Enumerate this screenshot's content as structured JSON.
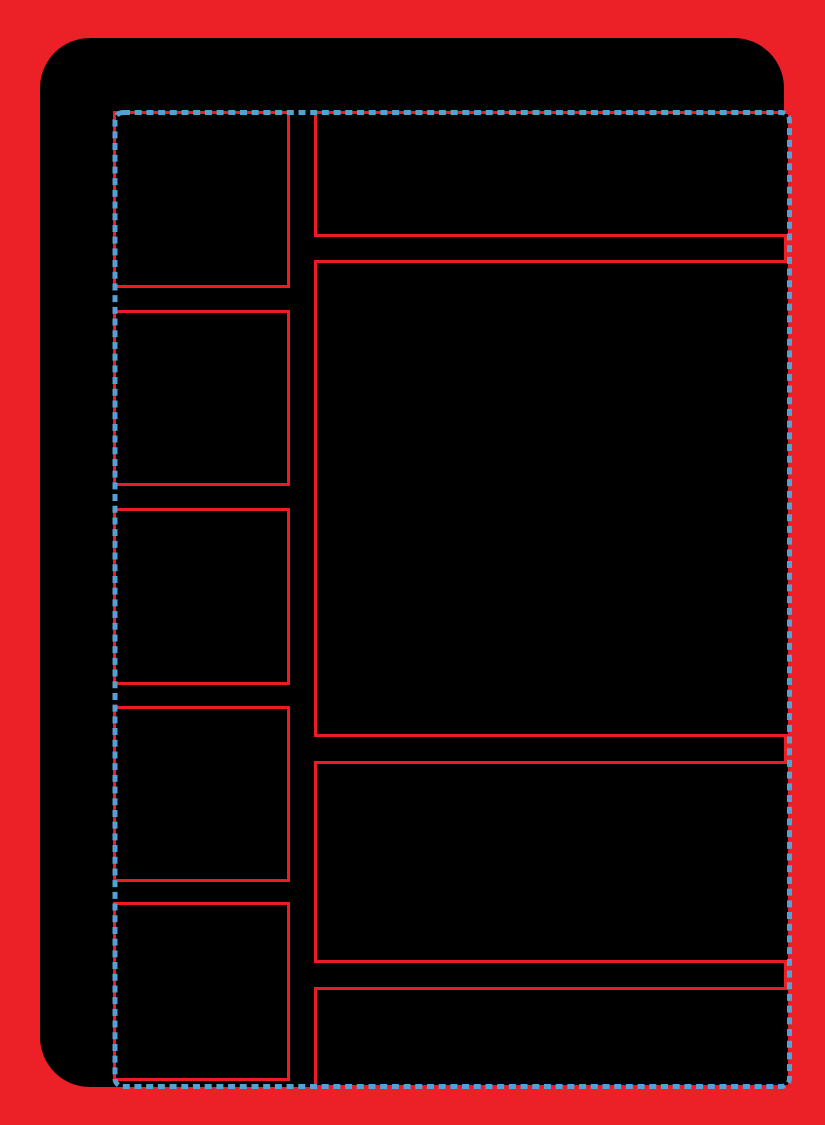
{
  "template": {
    "type": "blank-card-layout-template",
    "text_content": "none"
  },
  "colors": {
    "page_background": "#EC2127",
    "card_background": "#000000",
    "panel_outline": "#ED1C24",
    "guide_dash": "#55A1D6"
  },
  "guide": {
    "style": "dashed",
    "role": "safe-area-border"
  },
  "panels": {
    "left_column": [
      {
        "name": "left-panel-1",
        "content": ""
      },
      {
        "name": "left-panel-2",
        "content": ""
      },
      {
        "name": "left-panel-3",
        "content": ""
      },
      {
        "name": "left-panel-4",
        "content": ""
      },
      {
        "name": "left-panel-5",
        "content": ""
      }
    ],
    "right_column": [
      {
        "name": "right-panel-top",
        "content": ""
      },
      {
        "name": "right-panel-large",
        "content": ""
      },
      {
        "name": "right-panel-medium",
        "content": ""
      },
      {
        "name": "right-panel-bottom",
        "content": ""
      }
    ]
  }
}
